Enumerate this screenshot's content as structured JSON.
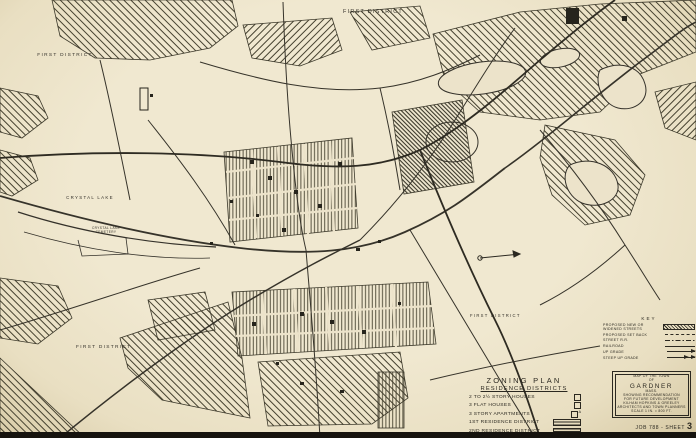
{
  "colors": {
    "paper": "#ece3ca",
    "ink": "#2b2820",
    "hatch": "#45412f",
    "photo_edge": "#16130e"
  },
  "map": {
    "district_labels": [
      {
        "position": "top-center",
        "text": "FIRST DISTRICT"
      },
      {
        "position": "upper-left",
        "text": "FIRST DISTRICT"
      },
      {
        "position": "lower-left",
        "text": "FIRST DISTRICT"
      },
      {
        "position": "center-right",
        "text": "FIRST DISTRICT"
      }
    ],
    "place_labels": {
      "crystal_lake": "CRYSTAL LAKE",
      "cemetery_line1": "CRYSTAL LAKE",
      "cemetery_line2": "CEMETERY"
    },
    "legend": {
      "title": "ZONING PLAN",
      "subtitle": "RESIDENCE DISTRICTS",
      "items": [
        {
          "label": "2 TO 2½ STORY HOUSES",
          "symbol": "open-square"
        },
        {
          "label": "3 FLAT HOUSES",
          "symbol": "open-square"
        },
        {
          "label": "3 STORY APARTMENTS",
          "symbol": "open-square-superscript-a",
          "superscript": "A"
        },
        {
          "label": "1ST RESIDENCE DISTRICT",
          "symbol": "striped-bar-light"
        },
        {
          "label": "2ND RESIDENCE DISTRICT",
          "symbol": "striped-bar-dense"
        }
      ]
    },
    "key": {
      "title": "KEY",
      "items": [
        {
          "label": "PROPOSED NEW OR WIDENED STREETS",
          "symbol": "hatched-bar"
        },
        {
          "label": "PROPOSED SET BACK",
          "symbol": "dashed-line"
        },
        {
          "label": "STREET R.R.",
          "symbol": "dash-dot-line"
        },
        {
          "label": "RAILROAD",
          "symbol": "solid-line"
        },
        {
          "label": "UP GRADE",
          "symbol": "arrow"
        },
        {
          "label": "STEEP UP GRADE",
          "symbol": "double-arrow"
        }
      ]
    },
    "title_block": {
      "lines": [
        "MAP OF THE TOWN",
        "OF",
        "GARDNER",
        "MASS.",
        "SHOWING RECOMMENDATION",
        "FOR FUTURE DEVELOPMENT",
        "KILHAM HOPKINS & GREELEY",
        "ARCHITECTS AND TOWN PLANNERS",
        "SCALE 1 IN. = 800 FT."
      ]
    },
    "sheet_label": {
      "prefix": "JOB 788 - SHEET",
      "number": "3"
    }
  }
}
